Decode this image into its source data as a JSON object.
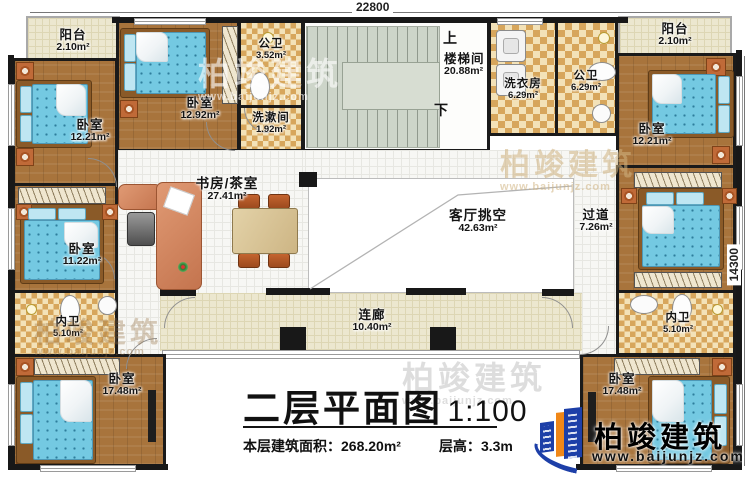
{
  "dimensions": {
    "width_top": "22800",
    "height_right": "14300"
  },
  "rooms": {
    "balcony_tl": {
      "name": "阳台",
      "area": "2.10m²"
    },
    "bedroom_tl": {
      "name": "卧室",
      "area": "12.21m²"
    },
    "bedroom_t2": {
      "name": "卧室",
      "area": "12.92m²"
    },
    "bath_top": {
      "name": "公卫",
      "area": "3.52m²"
    },
    "washroom": {
      "name": "洗漱间",
      "area": "1.92m²"
    },
    "stairwell": {
      "name": "楼梯间",
      "area": "20.88m²"
    },
    "laundry": {
      "name": "洗衣房",
      "area": "6.29m²"
    },
    "bath_tr": {
      "name": "公卫",
      "area": "6.29m²"
    },
    "balcony_tr": {
      "name": "阳台",
      "area": "2.10m²"
    },
    "bedroom_tr": {
      "name": "卧室",
      "area": "12.21m²"
    },
    "bedroom_ml": {
      "name": "卧室",
      "area": "11.22m²"
    },
    "study": {
      "name": "书房/茶室",
      "area": "27.41m²"
    },
    "living_void": {
      "name": "客厅挑空",
      "area": "42.63m²"
    },
    "hallway": {
      "name": "过道",
      "area": "7.26m²"
    },
    "bath_ml": {
      "name": "内卫",
      "area": "5.10m²"
    },
    "bath_mr": {
      "name": "内卫",
      "area": "5.10m²"
    },
    "bedroom_bl": {
      "name": "卧室",
      "area": "17.48m²"
    },
    "bedroom_br": {
      "name": "卧室",
      "area": "17.48m²"
    },
    "corridor": {
      "name": "连廊",
      "area": "10.40m²"
    }
  },
  "stairs": {
    "up": "上",
    "down": "下"
  },
  "title_block": {
    "title": "二层平面图",
    "scale": "1:100",
    "area_label": "本层建筑面积：",
    "area_value": "268.20m²",
    "height_label": "层高：",
    "height_value": "3.3m"
  },
  "logo": {
    "name": "柏竣建筑",
    "url": "www.baijunjz.com"
  },
  "watermark": {
    "text": "柏竣建筑",
    "url": "www.baijunjz.com"
  }
}
